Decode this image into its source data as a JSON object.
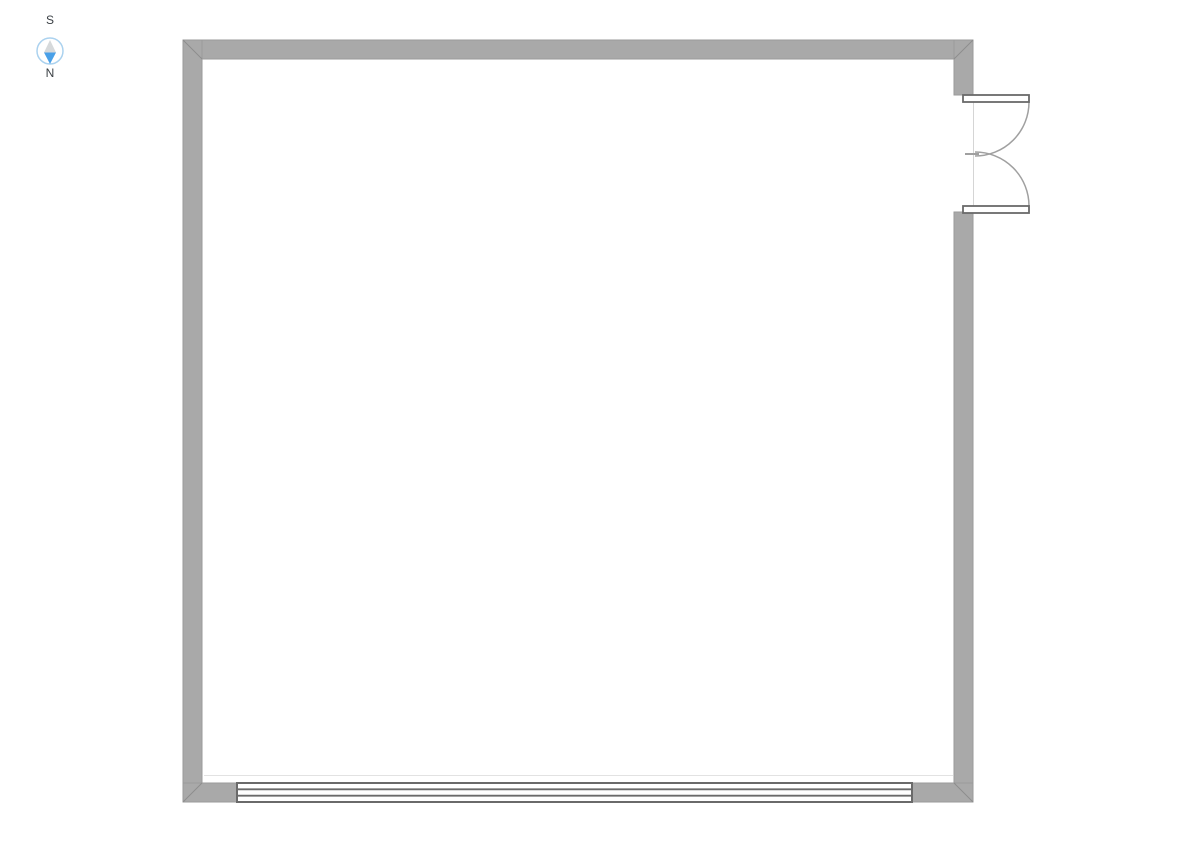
{
  "canvas": {
    "background": "#ffffff"
  },
  "compass": {
    "south_label": "S",
    "north_label": "N",
    "ring_color": "#abd2ef",
    "needle_north_color": "#49a0e8",
    "needle_tail_color": "#d6d9db",
    "label_color": "#3a3f44"
  },
  "floor_plan": {
    "wall_color": "#a9a9a9",
    "opening_frame_color": "#6a6a6a",
    "door_swing_color": "#a0a0a0",
    "jamb_line_color": "#d5d5d5",
    "guide_line_color": "#e2e2e2",
    "symbols": {
      "door": "double-swing-door-icon",
      "window": "sliding-window-icon",
      "compass": "compass-icon"
    }
  }
}
